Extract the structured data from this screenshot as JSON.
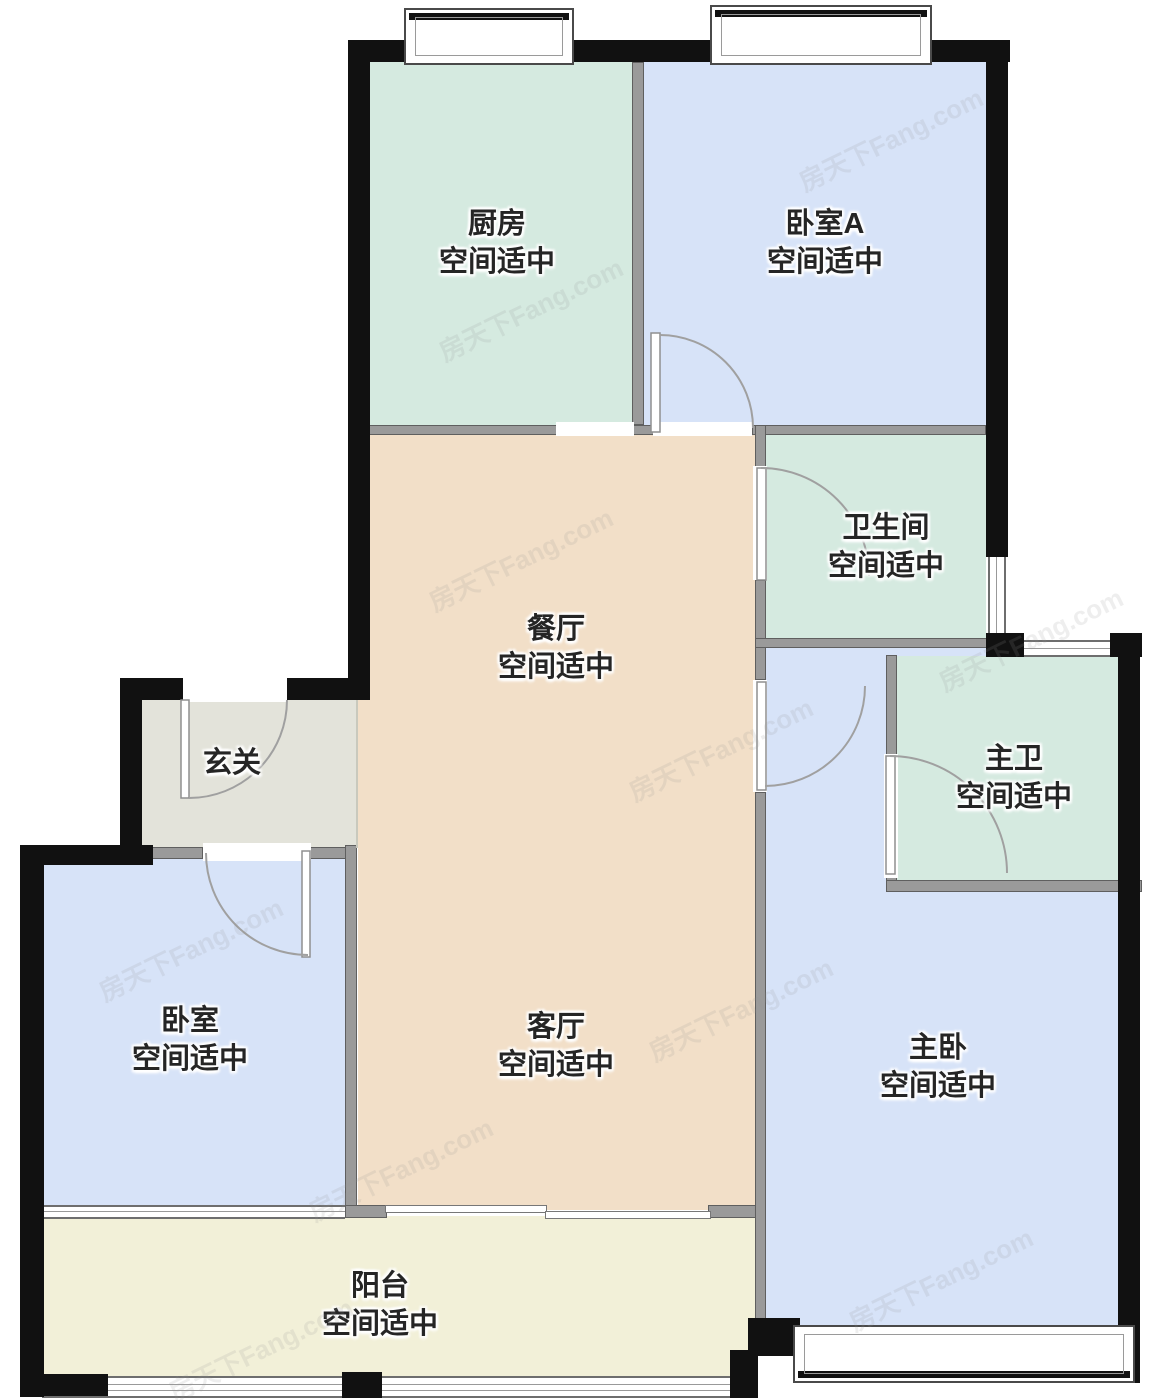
{
  "watermark": "房天下Fang.com",
  "colors": {
    "exterior_wall": "#111111",
    "interior_wall": "#9a9a9a",
    "kitchen_bath_fill": "#d5eae0",
    "bedroom_fill": "#d7e3f8",
    "living_dining_fill": "#f2dfc8",
    "entry_fill": "#e3e3da",
    "balcony_fill": "#f2f0d8",
    "label_text": "#252525"
  },
  "rooms": {
    "kitchen": {
      "name": "厨房",
      "note": "空间适中"
    },
    "bedroom_a": {
      "name": "卧室A",
      "note": "空间适中"
    },
    "bathroom": {
      "name": "卫生间",
      "note": "空间适中"
    },
    "dining": {
      "name": "餐厅",
      "note": "空间适中"
    },
    "entry": {
      "name": "玄关",
      "note": ""
    },
    "master_bath": {
      "name": "主卫",
      "note": "空间适中"
    },
    "bedroom": {
      "name": "卧室",
      "note": "空间适中"
    },
    "living": {
      "name": "客厅",
      "note": "空间适中"
    },
    "master_bedroom": {
      "name": "主卧",
      "note": "空间适中"
    },
    "balcony": {
      "name": "阳台",
      "note": "空间适中"
    }
  }
}
